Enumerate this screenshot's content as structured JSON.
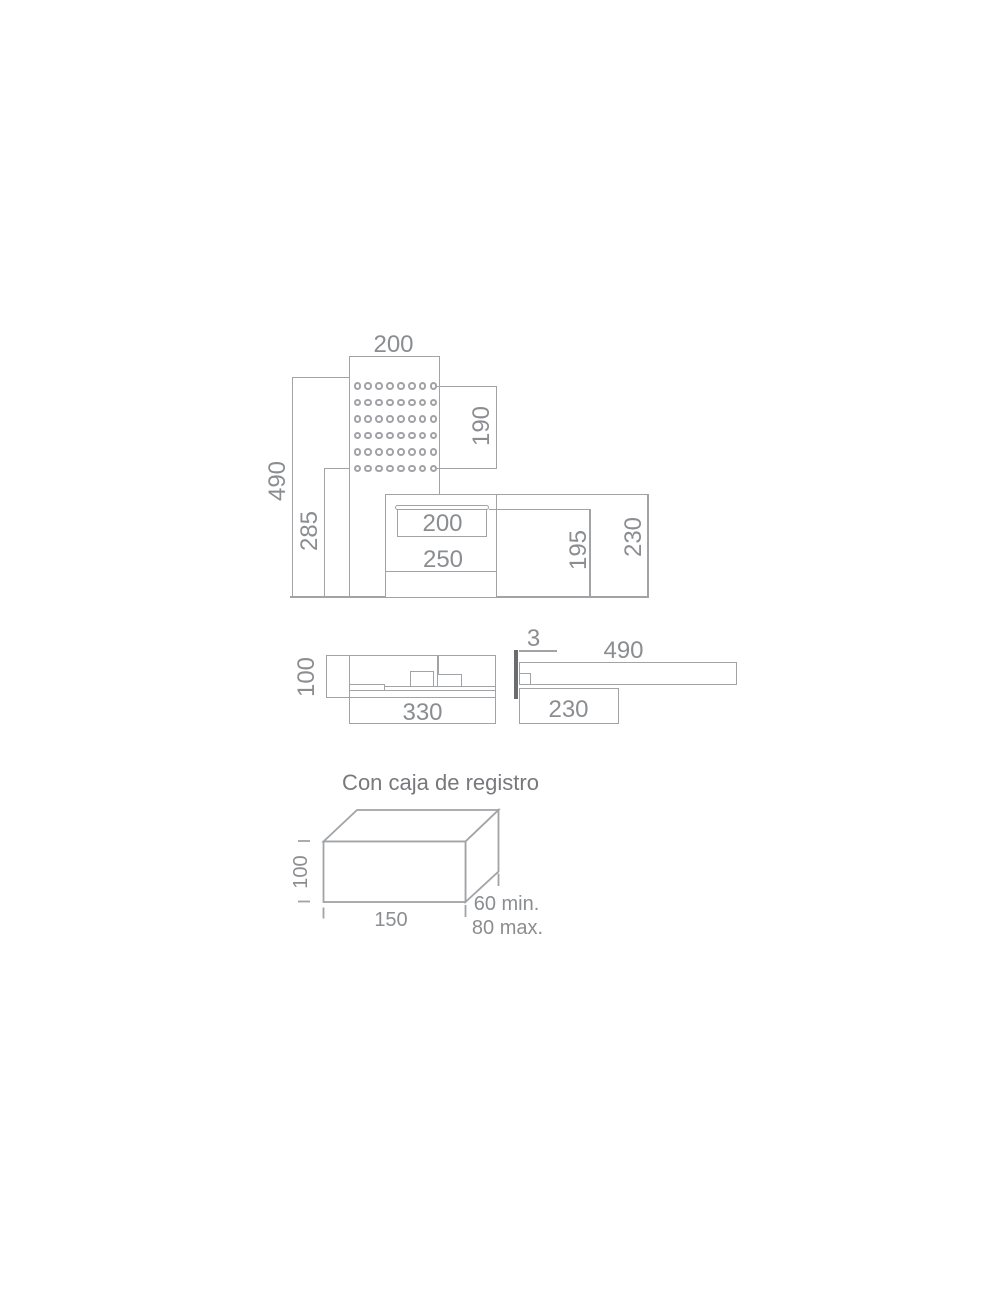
{
  "drawing": {
    "front_view": {
      "panel_width": "200",
      "perforation_height": "190",
      "total_height": "490",
      "below_perforation_height": "285",
      "spout_opening_width": "200",
      "spout_width": "250",
      "opening_to_bottom_height": "195",
      "spout_total_height": "230",
      "holes": {
        "rows": 6,
        "cols": 8
      }
    },
    "side_view": {
      "body_height": "100",
      "body_depth": "330"
    },
    "shelf_view": {
      "glass_thickness": "3",
      "shelf_length": "490",
      "mount_depth": "230"
    },
    "junction_box": {
      "caption": "Con caja de registro",
      "height": "100",
      "width": "150",
      "depth_min": "60 min.",
      "depth_max": "80 max."
    },
    "colors": {
      "line": "#a1a3a6",
      "label": "#8b8d90",
      "glass": "#6b6c6e",
      "title": "#77797c"
    }
  }
}
